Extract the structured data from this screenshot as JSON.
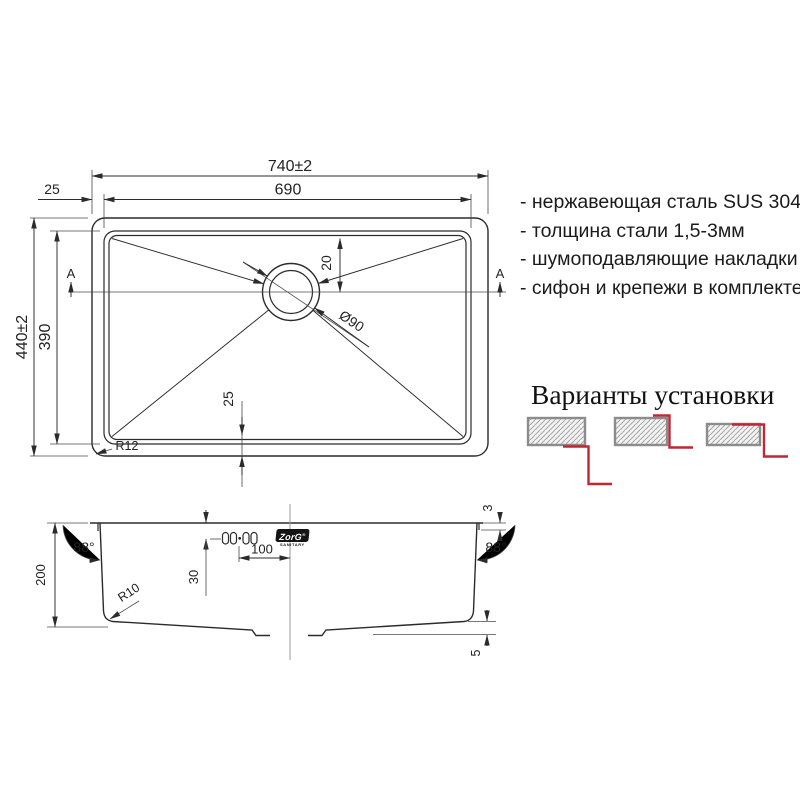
{
  "specs": {
    "items": [
      "- нержавеющая сталь SUS 304",
      "- толщина стали 1,5-3мм",
      "- шумоподавляющие накладки",
      "- сифон и крепежи в комплекте"
    ]
  },
  "install": {
    "title": "Варианты установки"
  },
  "top": {
    "w_outer": "740±2",
    "w_inner": "690",
    "rim_left": "25",
    "h_outer": "440±2",
    "h_inner": "390",
    "drain_offset": "20",
    "drain_dia": "Ø90",
    "rim_bottom": "25",
    "corner_radius": "R12",
    "section_a_left": "A",
    "section_a_right": "A"
  },
  "section": {
    "depth": "200",
    "angle_left": "88°",
    "angle_right": "88°",
    "bottom_radius": "R10",
    "clip_offset": "30",
    "drain_center": "100",
    "lip": "3",
    "slope": "5",
    "brand": "ZorG",
    "brand_reg": "®",
    "brand_sub": "SANITARY"
  },
  "colors": {
    "line": "#2b2b2b",
    "red": "#bf2733",
    "hatch_border": "#8c8c8c"
  }
}
